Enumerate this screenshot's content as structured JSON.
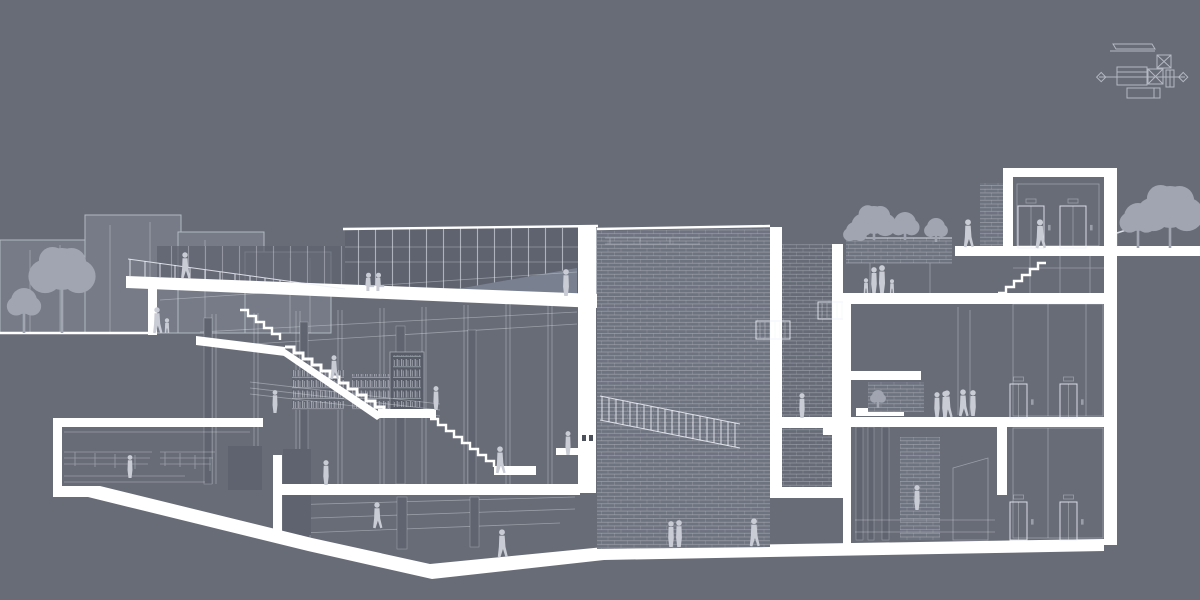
{
  "colors": {
    "background": "#686C77",
    "cut": "#FFFFFF",
    "line": "rgba(238,241,247,0.85)",
    "line_faint": "rgba(230,234,241,0.40)",
    "context_fill": "#767B87",
    "context_stroke": "#B3B8C2",
    "panel": "#5E636F",
    "tree": "#A0A5B1",
    "people": "#C9CCD4",
    "brick": "#6E7380",
    "shaft": "#666B77",
    "column": "#5F6470",
    "dark_tick": "#4B505A"
  },
  "key_plan": {
    "icon": "site-key-plan-icon",
    "parts": [
      "long-bar-building",
      "crossed-square-annex",
      "section-cut-line-with-diamond-ends",
      "main-block",
      "crossed-square-core",
      "small-tower-bar",
      "lower-block"
    ]
  },
  "people": [
    {
      "x": 185,
      "y": 278,
      "h": 26,
      "pose": "walk"
    },
    {
      "x": 157,
      "y": 333,
      "h": 26,
      "pose": "walk"
    },
    {
      "x": 167,
      "y": 333,
      "h": 15,
      "pose": "child"
    },
    {
      "x": 368,
      "y": 291,
      "h": 18,
      "pose": "sit"
    },
    {
      "x": 378,
      "y": 291,
      "h": 18,
      "pose": "sit"
    },
    {
      "x": 566,
      "y": 296,
      "h": 27,
      "pose": "stand"
    },
    {
      "x": 334,
      "y": 379,
      "h": 24,
      "pose": "walk"
    },
    {
      "x": 275,
      "y": 413,
      "h": 23,
      "pose": "stand"
    },
    {
      "x": 436,
      "y": 410,
      "h": 24,
      "pose": "stand"
    },
    {
      "x": 500,
      "y": 473,
      "h": 27,
      "pose": "walk"
    },
    {
      "x": 377,
      "y": 528,
      "h": 26,
      "pose": "walk"
    },
    {
      "x": 502,
      "y": 557,
      "h": 28,
      "pose": "walk"
    },
    {
      "x": 130,
      "y": 478,
      "h": 23,
      "pose": "stand"
    },
    {
      "x": 326,
      "y": 485,
      "h": 25,
      "pose": "stand"
    },
    {
      "x": 568,
      "y": 455,
      "h": 24,
      "pose": "stand"
    },
    {
      "x": 671,
      "y": 547,
      "h": 26,
      "pose": "stand"
    },
    {
      "x": 679,
      "y": 547,
      "h": 27,
      "pose": "stand"
    },
    {
      "x": 754,
      "y": 546,
      "h": 28,
      "pose": "walk"
    },
    {
      "x": 802,
      "y": 418,
      "h": 25,
      "pose": "stand"
    },
    {
      "x": 866,
      "y": 293,
      "h": 15,
      "pose": "child"
    },
    {
      "x": 874,
      "y": 293,
      "h": 26,
      "pose": "stand"
    },
    {
      "x": 882,
      "y": 293,
      "h": 28,
      "pose": "stand"
    },
    {
      "x": 892,
      "y": 293,
      "h": 14,
      "pose": "child"
    },
    {
      "x": 968,
      "y": 247,
      "h": 28,
      "pose": "walk"
    },
    {
      "x": 1040,
      "y": 248,
      "h": 29,
      "pose": "walk"
    },
    {
      "x": 947,
      "y": 417,
      "h": 27,
      "pose": "walk"
    },
    {
      "x": 937,
      "y": 417,
      "h": 25,
      "pose": "stand"
    },
    {
      "x": 945,
      "y": 417,
      "h": 26,
      "pose": "stand"
    },
    {
      "x": 963,
      "y": 416,
      "h": 27,
      "pose": "walk"
    },
    {
      "x": 973,
      "y": 416,
      "h": 26,
      "pose": "stand"
    },
    {
      "x": 917,
      "y": 510,
      "h": 25,
      "pose": "stand"
    }
  ],
  "trees": [
    {
      "x": 24,
      "top": 288,
      "r": 13,
      "trunkTo": 333,
      "type": "round"
    },
    {
      "x": 62,
      "top": 248,
      "r": 21,
      "trunkTo": 333,
      "type": "leafy"
    },
    {
      "x": 855,
      "top": 222,
      "r": 9,
      "trunkTo": 240,
      "type": "round"
    },
    {
      "x": 874,
      "top": 206,
      "r": 14,
      "trunkTo": 240,
      "type": "leafy"
    },
    {
      "x": 905,
      "top": 212,
      "r": 11,
      "trunkTo": 240,
      "type": "round"
    },
    {
      "x": 936,
      "top": 218,
      "r": 9,
      "trunkTo": 242,
      "type": "round"
    },
    {
      "x": 1138,
      "top": 203,
      "r": 14,
      "trunkTo": 248,
      "type": "round"
    },
    {
      "x": 1170,
      "top": 186,
      "r": 21,
      "trunkTo": 248,
      "type": "leafy"
    },
    {
      "x": 878,
      "top": 390,
      "r": 6,
      "trunkTo": 408,
      "type": "round"
    }
  ],
  "elevators": [
    {
      "x": 1018,
      "y": 206,
      "w": 26,
      "h": 42
    },
    {
      "x": 1060,
      "y": 206,
      "w": 26,
      "h": 42
    },
    {
      "x": 1010,
      "y": 384,
      "w": 17,
      "h": 34
    },
    {
      "x": 1060,
      "y": 384,
      "w": 17,
      "h": 34
    },
    {
      "x": 1010,
      "y": 502,
      "w": 17,
      "h": 38
    },
    {
      "x": 1060,
      "y": 502,
      "w": 17,
      "h": 38
    }
  ]
}
